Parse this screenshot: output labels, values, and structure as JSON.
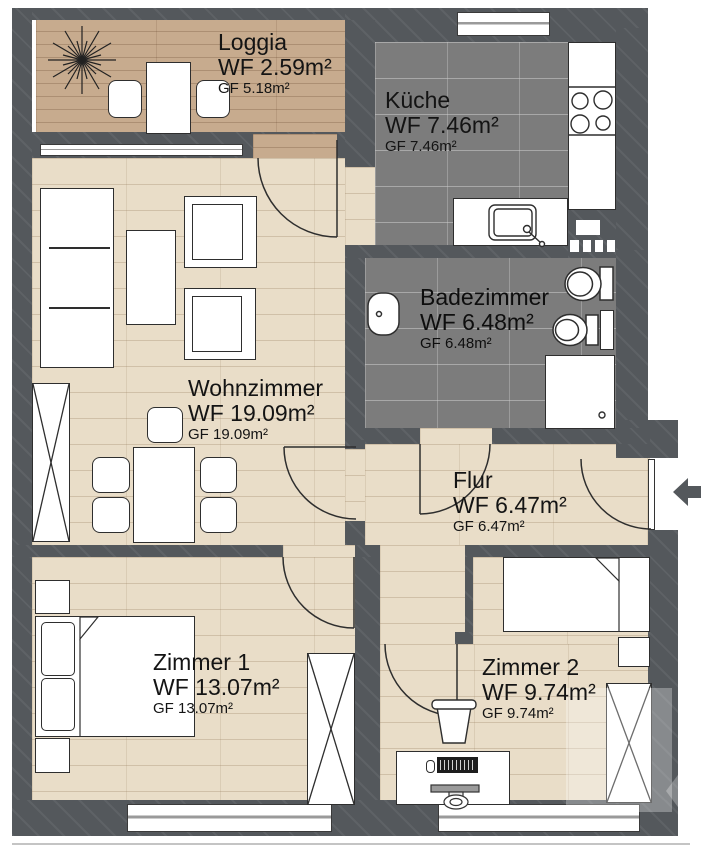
{
  "plan": {
    "type": "apartment-floor-plan",
    "language": "de"
  },
  "rooms": [
    {
      "id": "loggia",
      "name": "Loggia",
      "wf": "WF 2.59m²",
      "gf": "GF 5.18m²"
    },
    {
      "id": "kueche",
      "name": "Küche",
      "wf": "WF 7.46m²",
      "gf": "GF 7.46m²"
    },
    {
      "id": "badezimmer",
      "name": "Badezimmer",
      "wf": "WF 6.48m²",
      "gf": "GF 6.48m²"
    },
    {
      "id": "wohnzimmer",
      "name": "Wohnzimmer",
      "wf": "WF 19.09m²",
      "gf": "GF 19.09m²"
    },
    {
      "id": "flur",
      "name": "Flur",
      "wf": "WF 6.47m²",
      "gf": "GF 6.47m²"
    },
    {
      "id": "zimmer1",
      "name": "Zimmer 1",
      "wf": "WF 13.07m²",
      "gf": "GF 13.07m²"
    },
    {
      "id": "zimmer2",
      "name": "Zimmer 2",
      "wf": "WF 9.74m²",
      "gf": "GF 9.74m²"
    }
  ],
  "colors": {
    "wall": "#54585c",
    "wood_light": "#e9ddc8",
    "wood_loggia": "#c7ab8e",
    "tile_dark": "#7c7c7c",
    "outline": "#2e2e2e",
    "background": "#ffffff"
  },
  "icons": {
    "entrance": "arrow-left-icon",
    "fixtures": [
      "plant-icon",
      "stove-icon",
      "kitchen-sink-icon",
      "bath-sink-icon",
      "toilet-icon",
      "bidet-icon",
      "shower-icon",
      "bed-icon",
      "wardrobe-icon",
      "desk-icon",
      "monitor-icon",
      "keyboard-icon"
    ]
  }
}
